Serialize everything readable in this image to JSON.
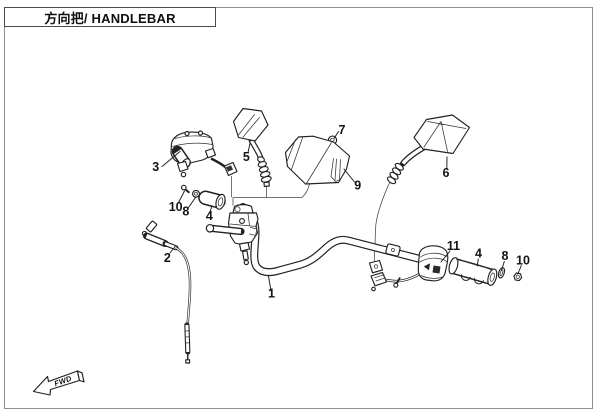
{
  "header": {
    "title": "方向把/ HANDLEBAR"
  },
  "direction_arrow": {
    "label": "FWD"
  },
  "callouts": {
    "c1": "1",
    "c2": "2",
    "c3": "3",
    "c4_left": "4",
    "c4_right": "4",
    "c5": "5",
    "c6": "6",
    "c7": "7",
    "c8_left": "8",
    "c8_right": "8",
    "c9": "9",
    "c10_left": "10",
    "c10_right": "10",
    "c11": "11"
  },
  "colors": {
    "line_art": "#222222",
    "page_border": "#8d8d8d",
    "background": "#ffffff"
  }
}
